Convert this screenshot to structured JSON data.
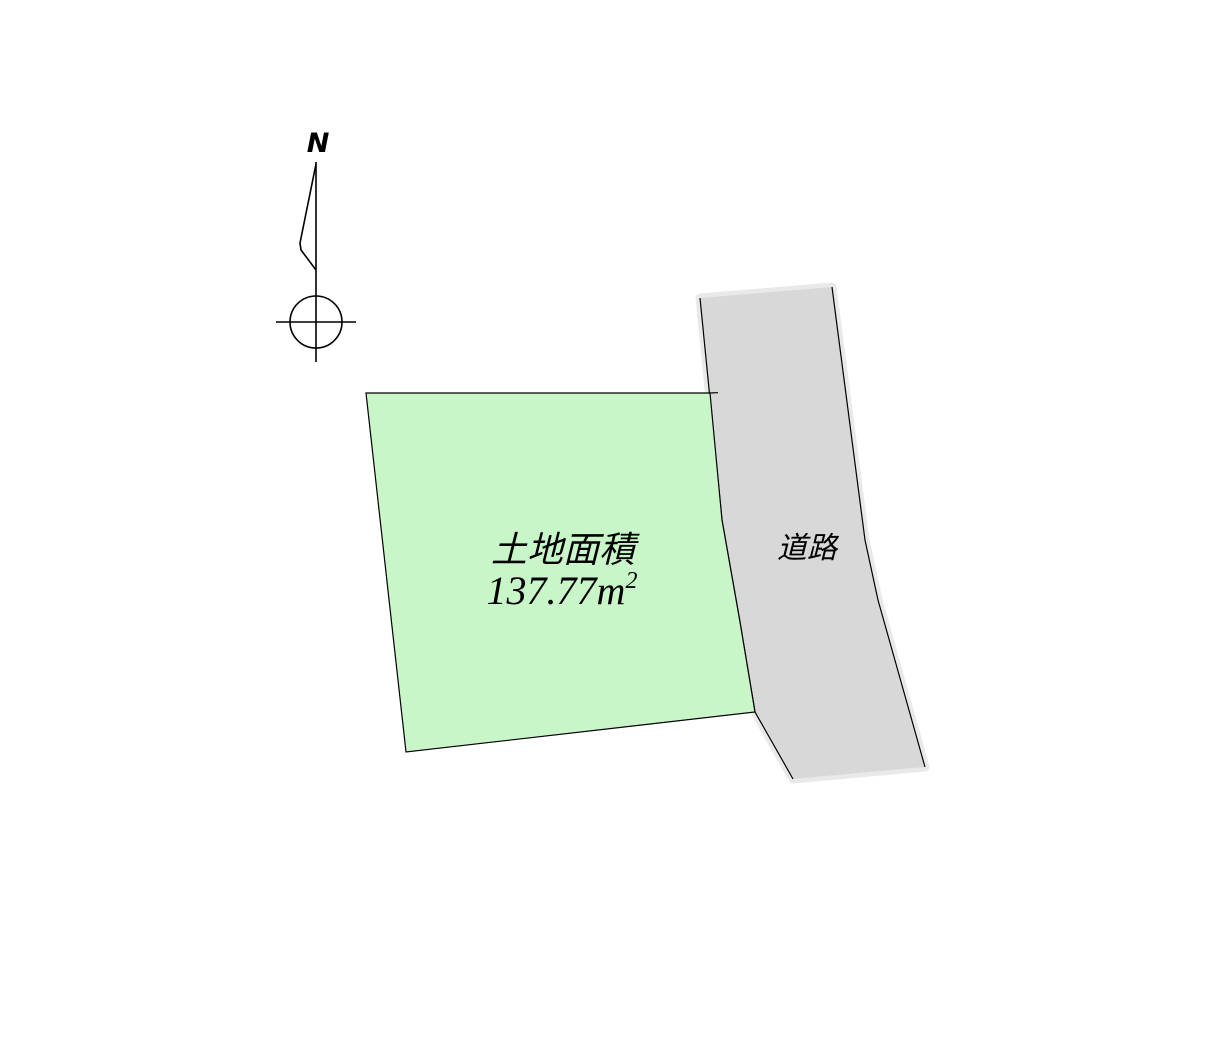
{
  "compass": {
    "north_label": "N"
  },
  "parcel": {
    "name_label": "土地面積",
    "area_text": "137.77㎡",
    "area_value": "137.77",
    "area_unit_base": "m",
    "area_unit_exponent": "2",
    "fill_color": "#c9f6c9"
  },
  "road": {
    "label": "道路",
    "fill_color": "#d8d8d8",
    "halo_color": "#e9e9e9"
  },
  "colors": {
    "background": "#ffffff",
    "line": "#000000"
  }
}
